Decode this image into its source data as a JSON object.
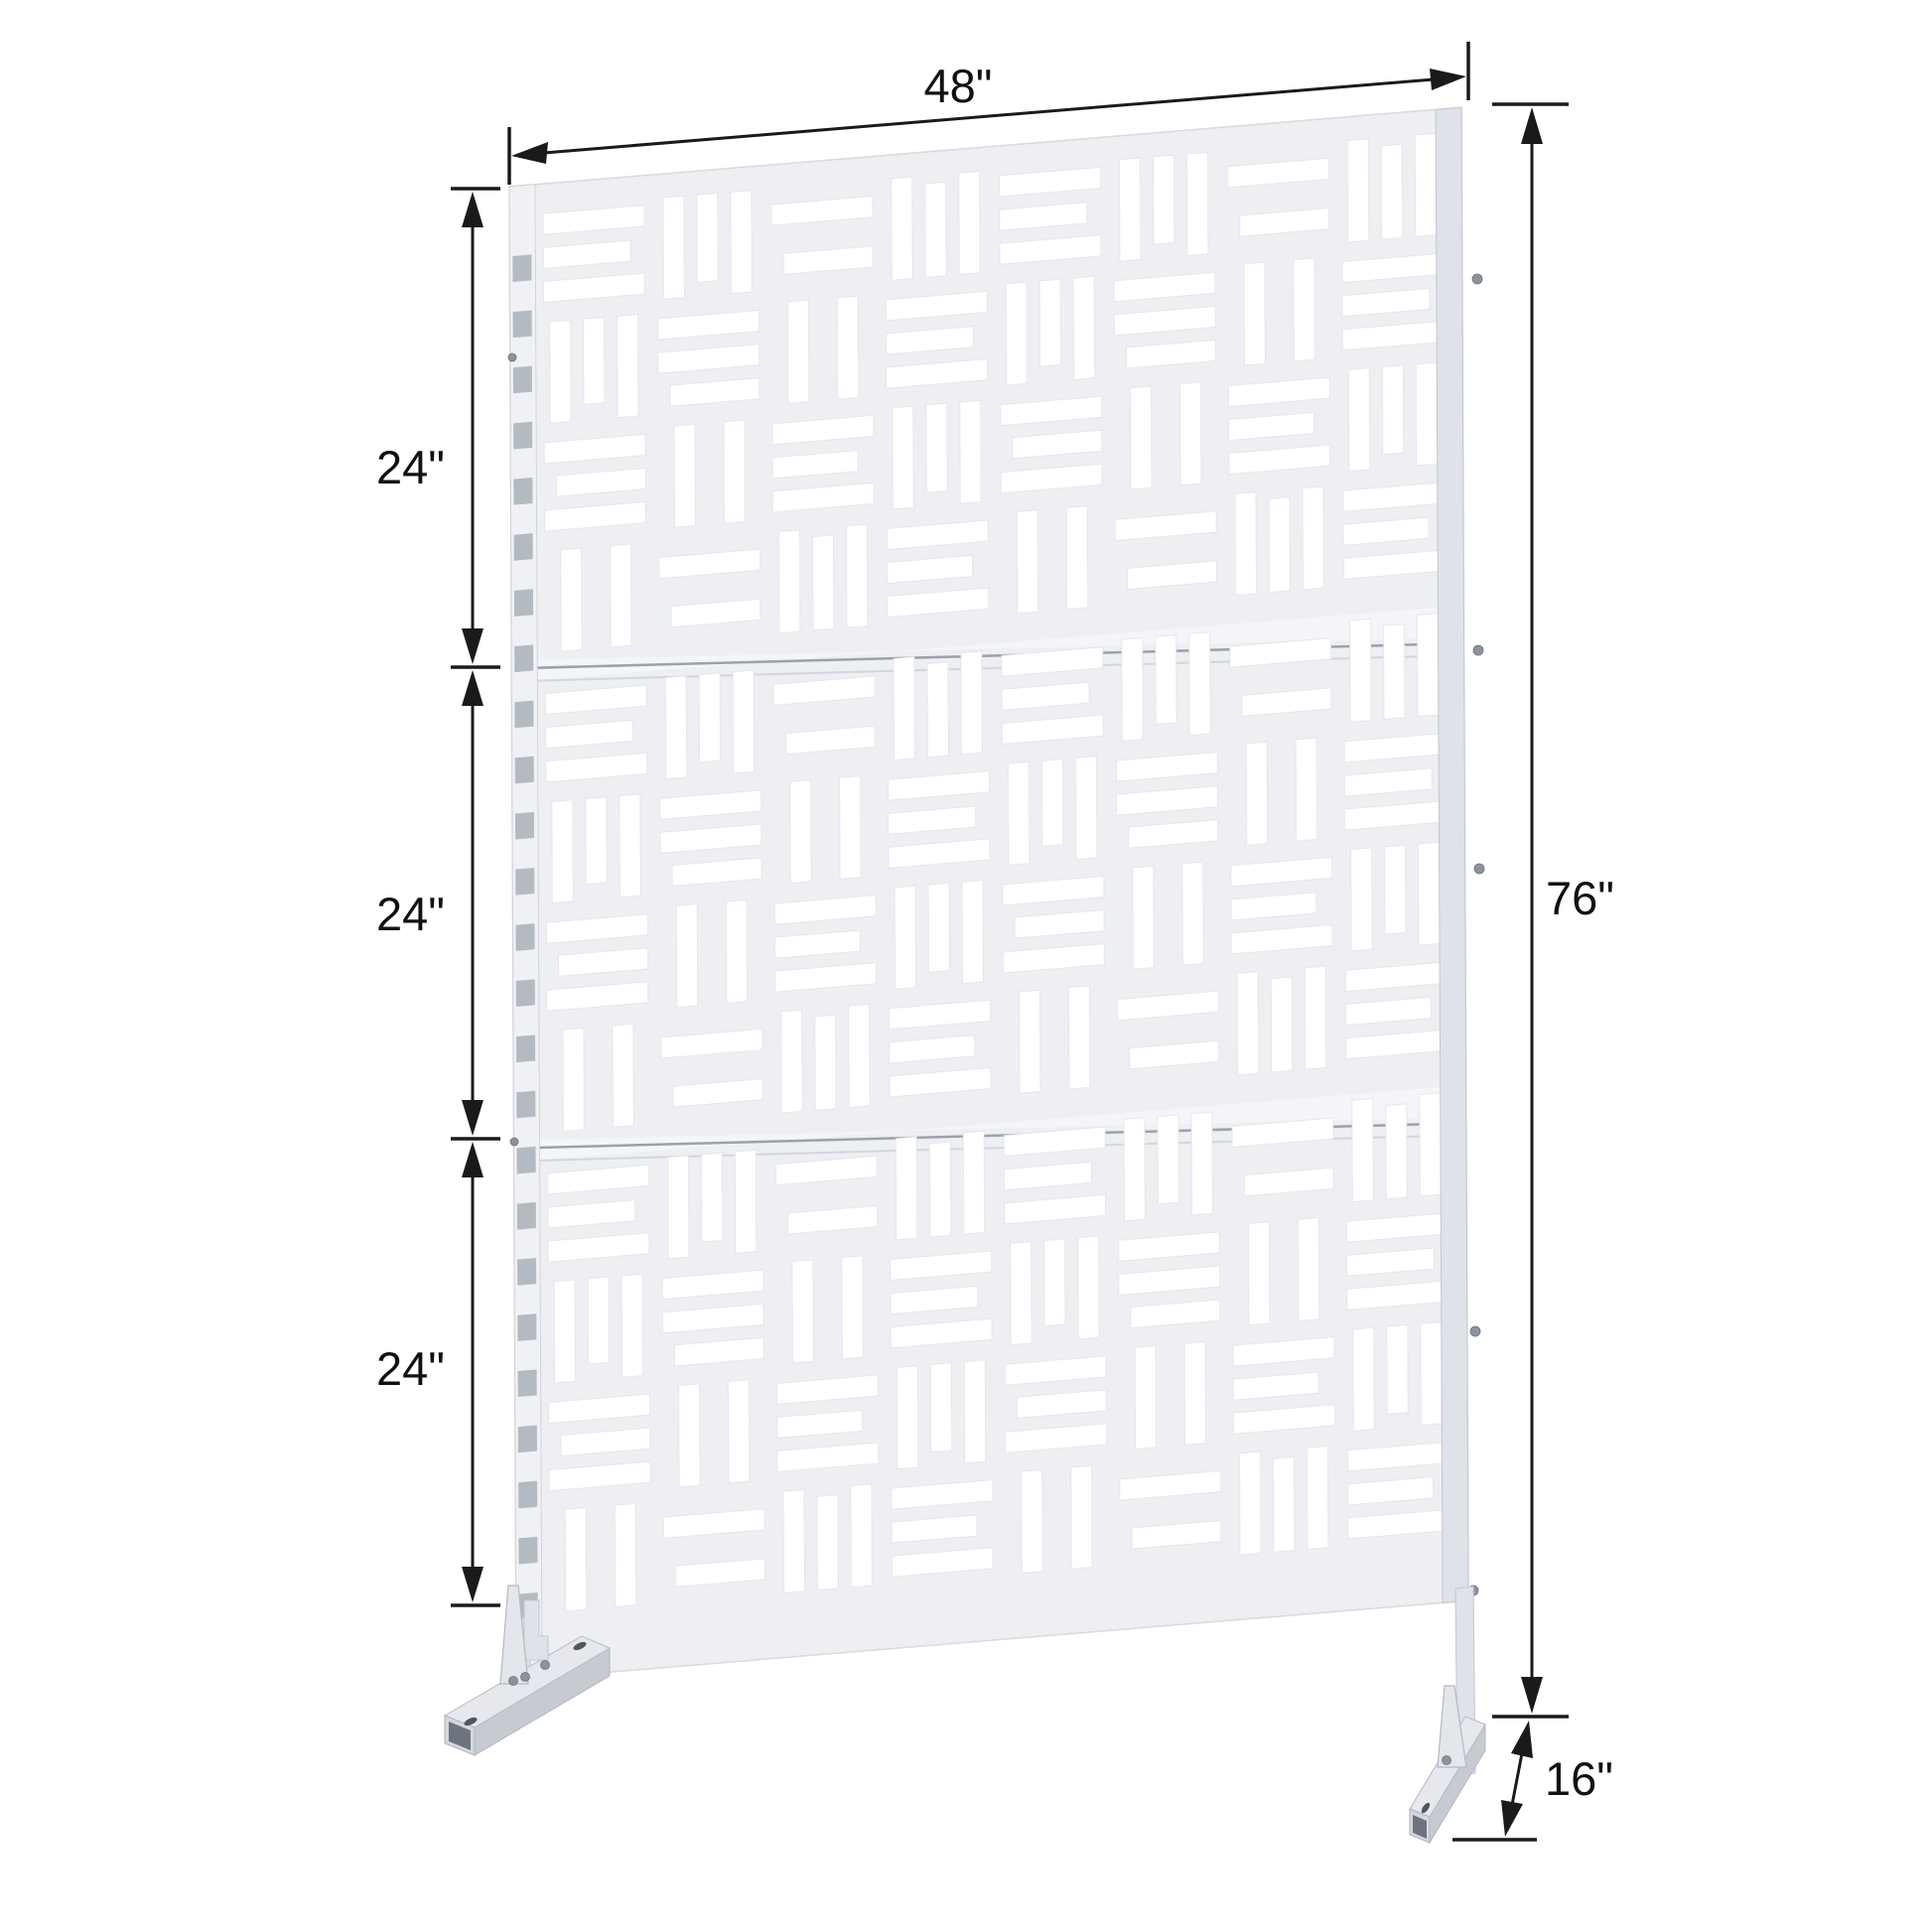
{
  "diagram": {
    "title": "privacy-screen-dimension-diagram",
    "product": {
      "name": "outdoor-privacy-screen-with-stand",
      "panel_color": "#edeff3",
      "cutout_color": "#ffffff",
      "frame_color": "#dfe2e8",
      "annotation_color": "#111111",
      "background_color": "#ffffff",
      "panel_count": 3
    },
    "dimensions": {
      "width": {
        "label": "48\"",
        "orientation": "top-edge"
      },
      "height": {
        "label": "76\"",
        "orientation": "right-side"
      },
      "depth": {
        "label": "16\"",
        "orientation": "foot-base"
      },
      "sections": [
        {
          "label": "24\""
        },
        {
          "label": "24\""
        },
        {
          "label": "24\""
        }
      ]
    }
  }
}
